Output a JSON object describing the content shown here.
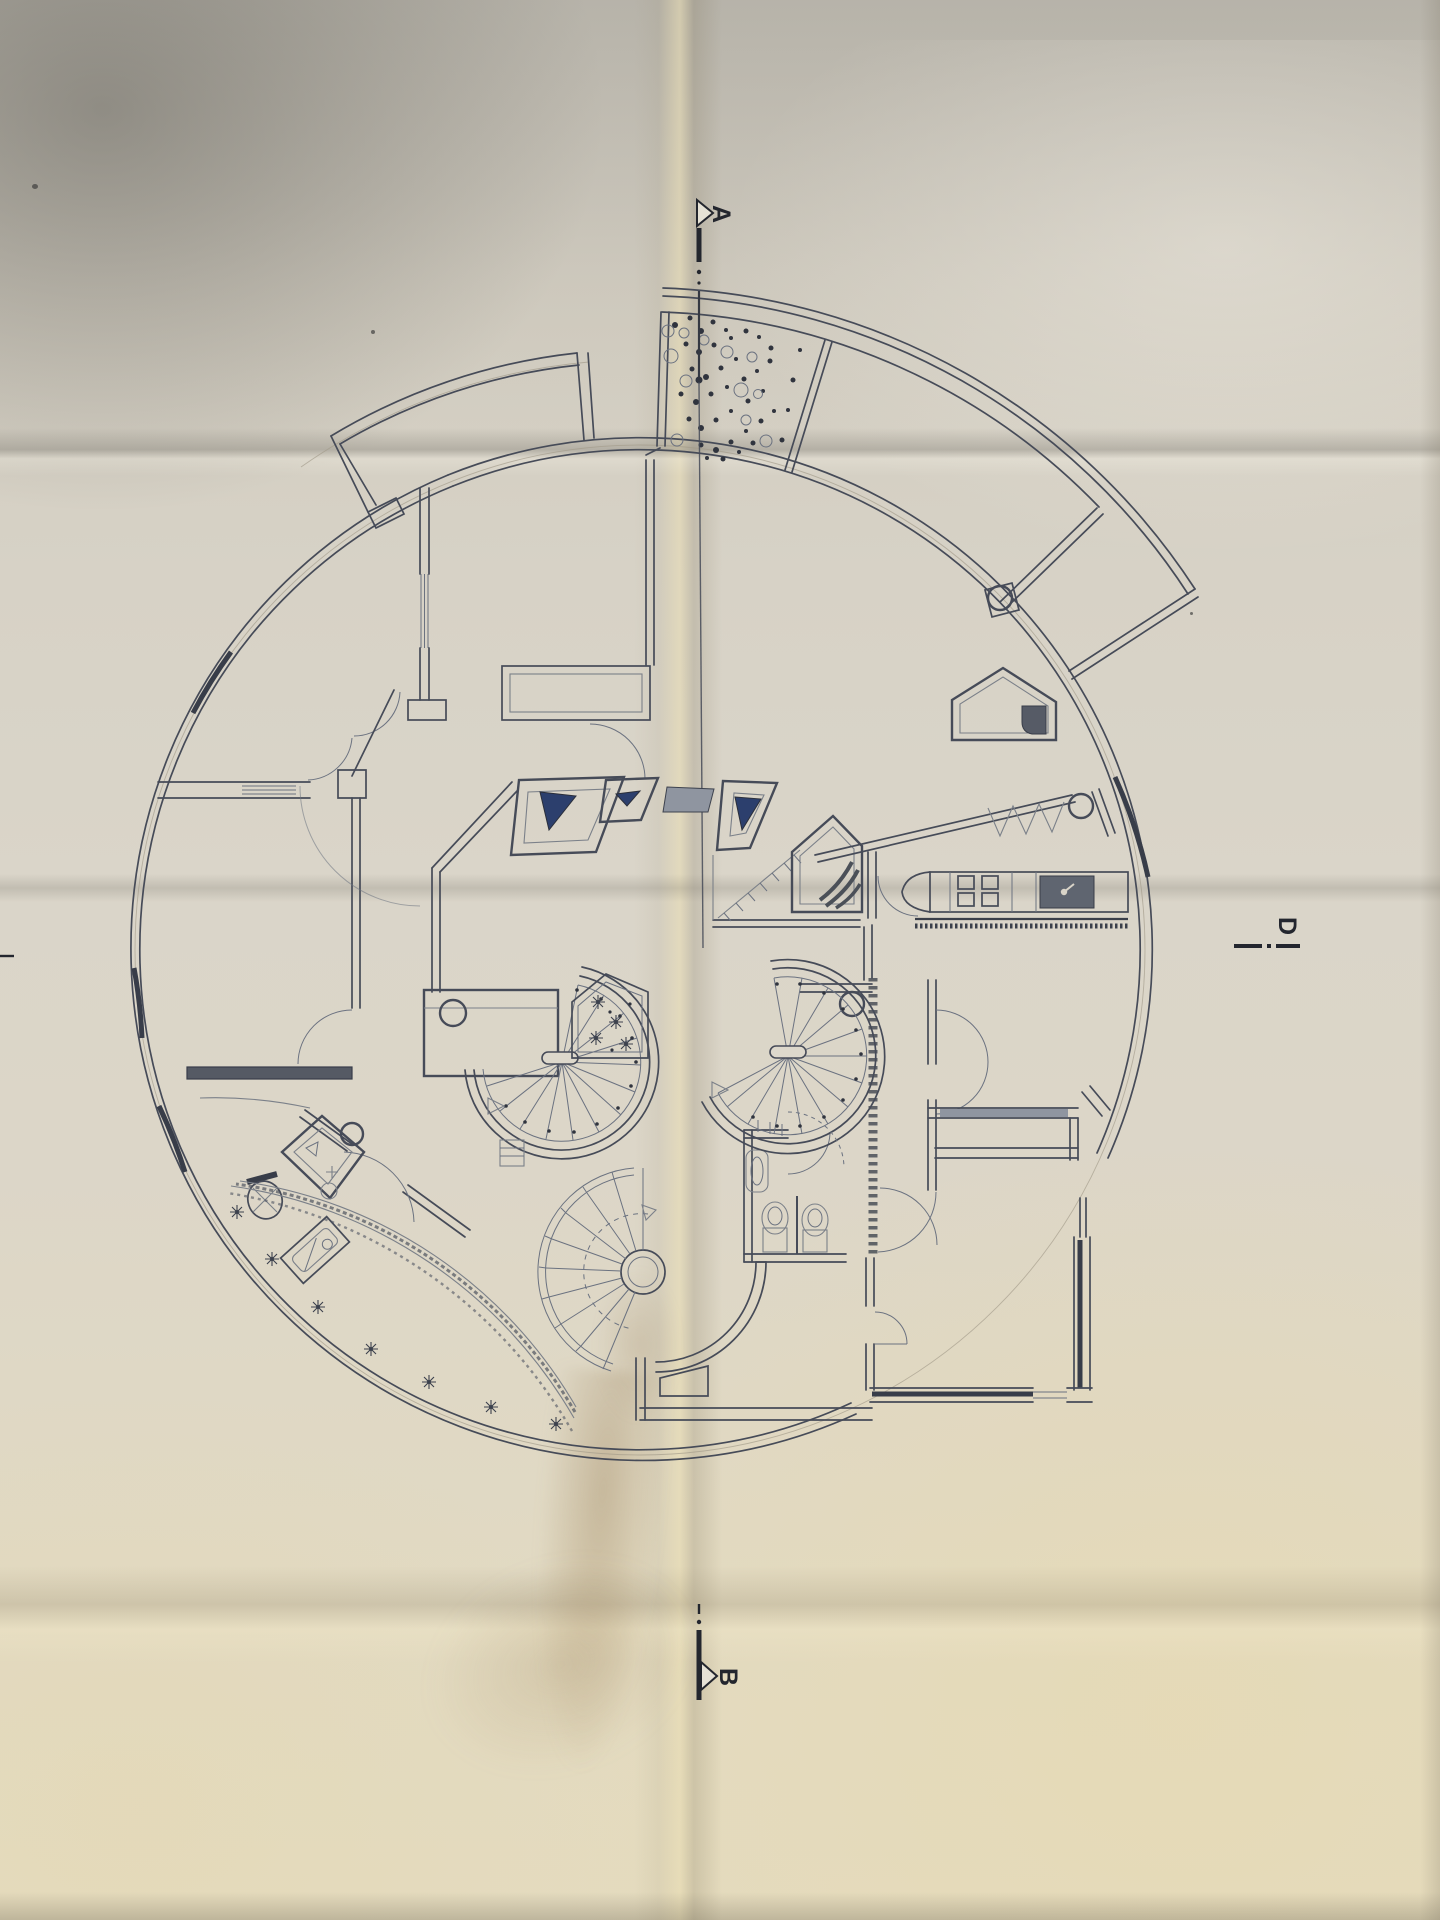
{
  "markers": {
    "section_a": "A",
    "section_b": "B",
    "section_d": "D"
  },
  "palette": {
    "paper": "#d8d3c7",
    "ink": "#464b58",
    "ink_dark": "#383d49",
    "skylight_blue": "#2c3f6d",
    "window_gray": "#8f95a0",
    "window_dark": "#555a64",
    "fixture_dark": "#5f6570"
  }
}
